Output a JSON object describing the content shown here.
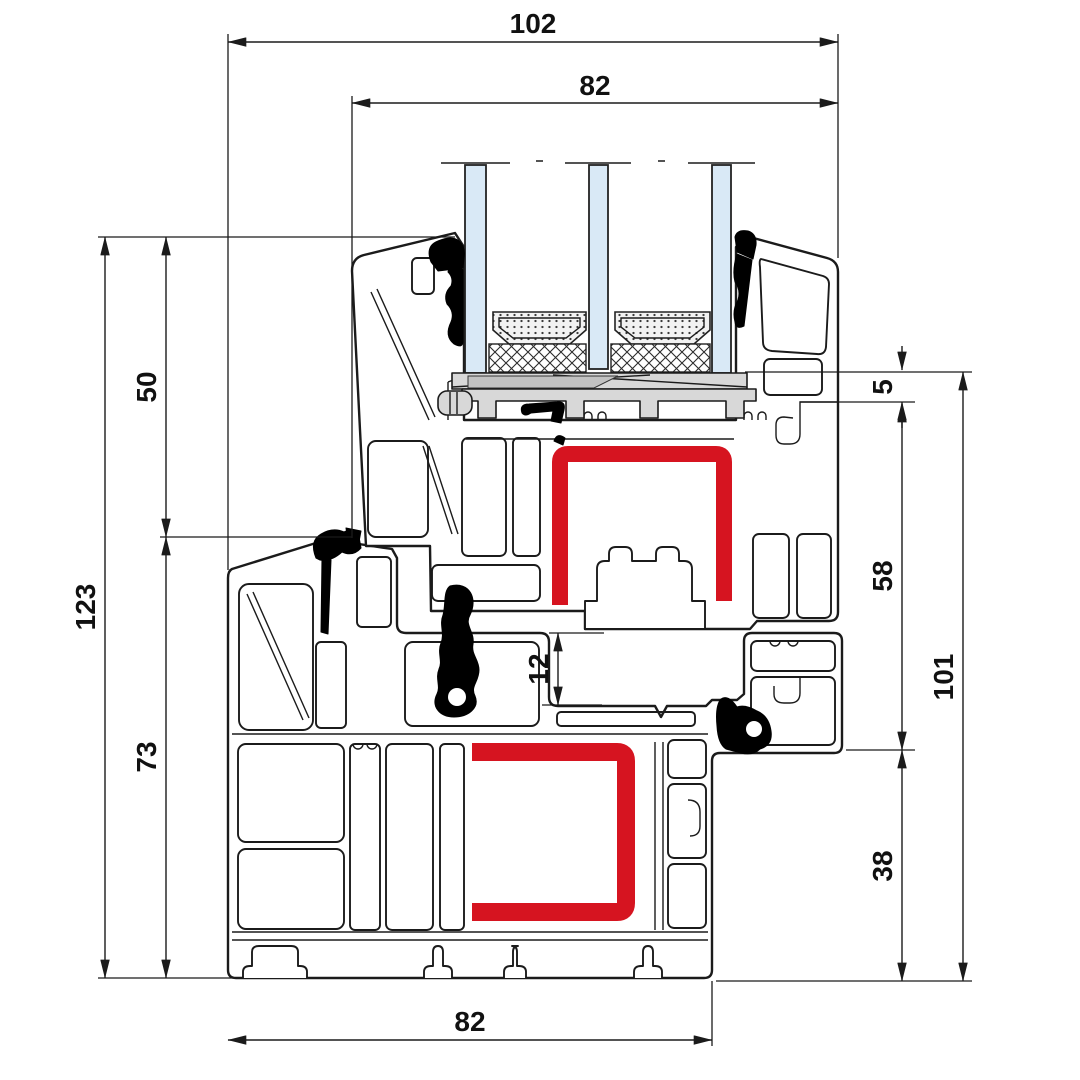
{
  "drawing": {
    "name": "window-profile-cross-section",
    "dims": {
      "top_overall": "102",
      "top_sash": "82",
      "left_total": "123",
      "left_upper": "50",
      "left_lower": "73",
      "right_overlap": "5",
      "right_sash": "58",
      "right_lower": "38",
      "right_total": "101",
      "mid_rebate": "12",
      "bottom_frame": "82"
    },
    "colors": {
      "line": "#1b1b1b",
      "steel": "#d61420",
      "glass": "#d9e9f6",
      "packer": "#d8d8d8",
      "gasket": "#000000",
      "background": "#ffffff"
    }
  }
}
